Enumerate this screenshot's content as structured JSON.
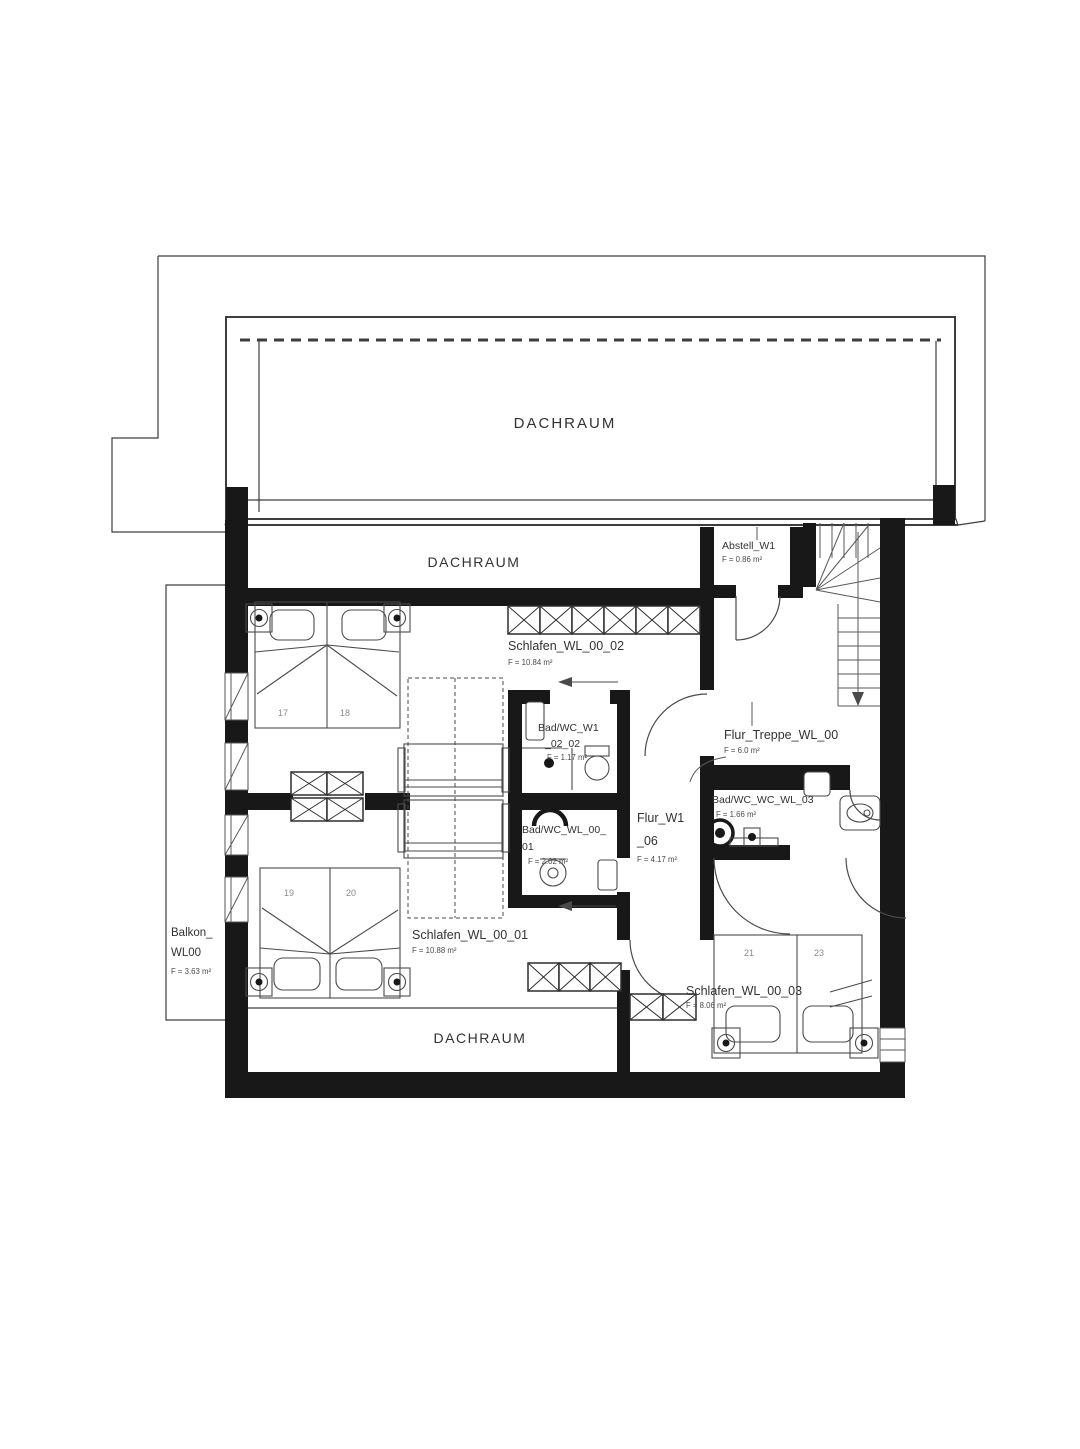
{
  "colors": {
    "background": "#ffffff",
    "wall_ink": "#181818",
    "line_ink": "#3d3d3d",
    "label_ink": "#323232"
  },
  "rooms": {
    "dachraum_top": {
      "label": "DACHRAUM"
    },
    "dachraum_mid": {
      "label": "DACHRAUM"
    },
    "dachraum_bottom": {
      "label": "DACHRAUM"
    },
    "abstell": {
      "label": "Abstell_W1",
      "area": "F = 0.86 m²"
    },
    "schlafen_02": {
      "label": "Schlafen_WL_00_02",
      "area": "F = 10.84 m²"
    },
    "bad_02": {
      "line1": "Bad/WC_W1",
      "line2": "_02_02",
      "area": "F = 1.17 m²"
    },
    "flur_treppe": {
      "label": "Flur_Treppe_WL_00",
      "area": "F = 6.0 m²"
    },
    "bad_03": {
      "label": "Bad/WC_WC_WL_03",
      "area": "F = 1.66 m²"
    },
    "flur_06": {
      "line1": "Flur_W1",
      "line2": "_06",
      "area": "F = 4.17 m²"
    },
    "bad_01": {
      "line1": "Bad/WC_WL_00_",
      "line2": "01",
      "area": "F = 2.02 m²"
    },
    "schlafen_01": {
      "label": "Schlafen_WL_00_01",
      "area": "F = 10.88 m²"
    },
    "schlafen_03": {
      "label": "Schlafen_WL_00_03",
      "area": "F = 8.06 m²"
    },
    "balkon": {
      "line1": "Balkon_",
      "line2": "WL00",
      "area": "F = 3.63 m²"
    }
  },
  "beds": {
    "n17": "17",
    "n18": "18",
    "n19": "19",
    "n20": "20",
    "n21": "21",
    "n23": "23"
  }
}
